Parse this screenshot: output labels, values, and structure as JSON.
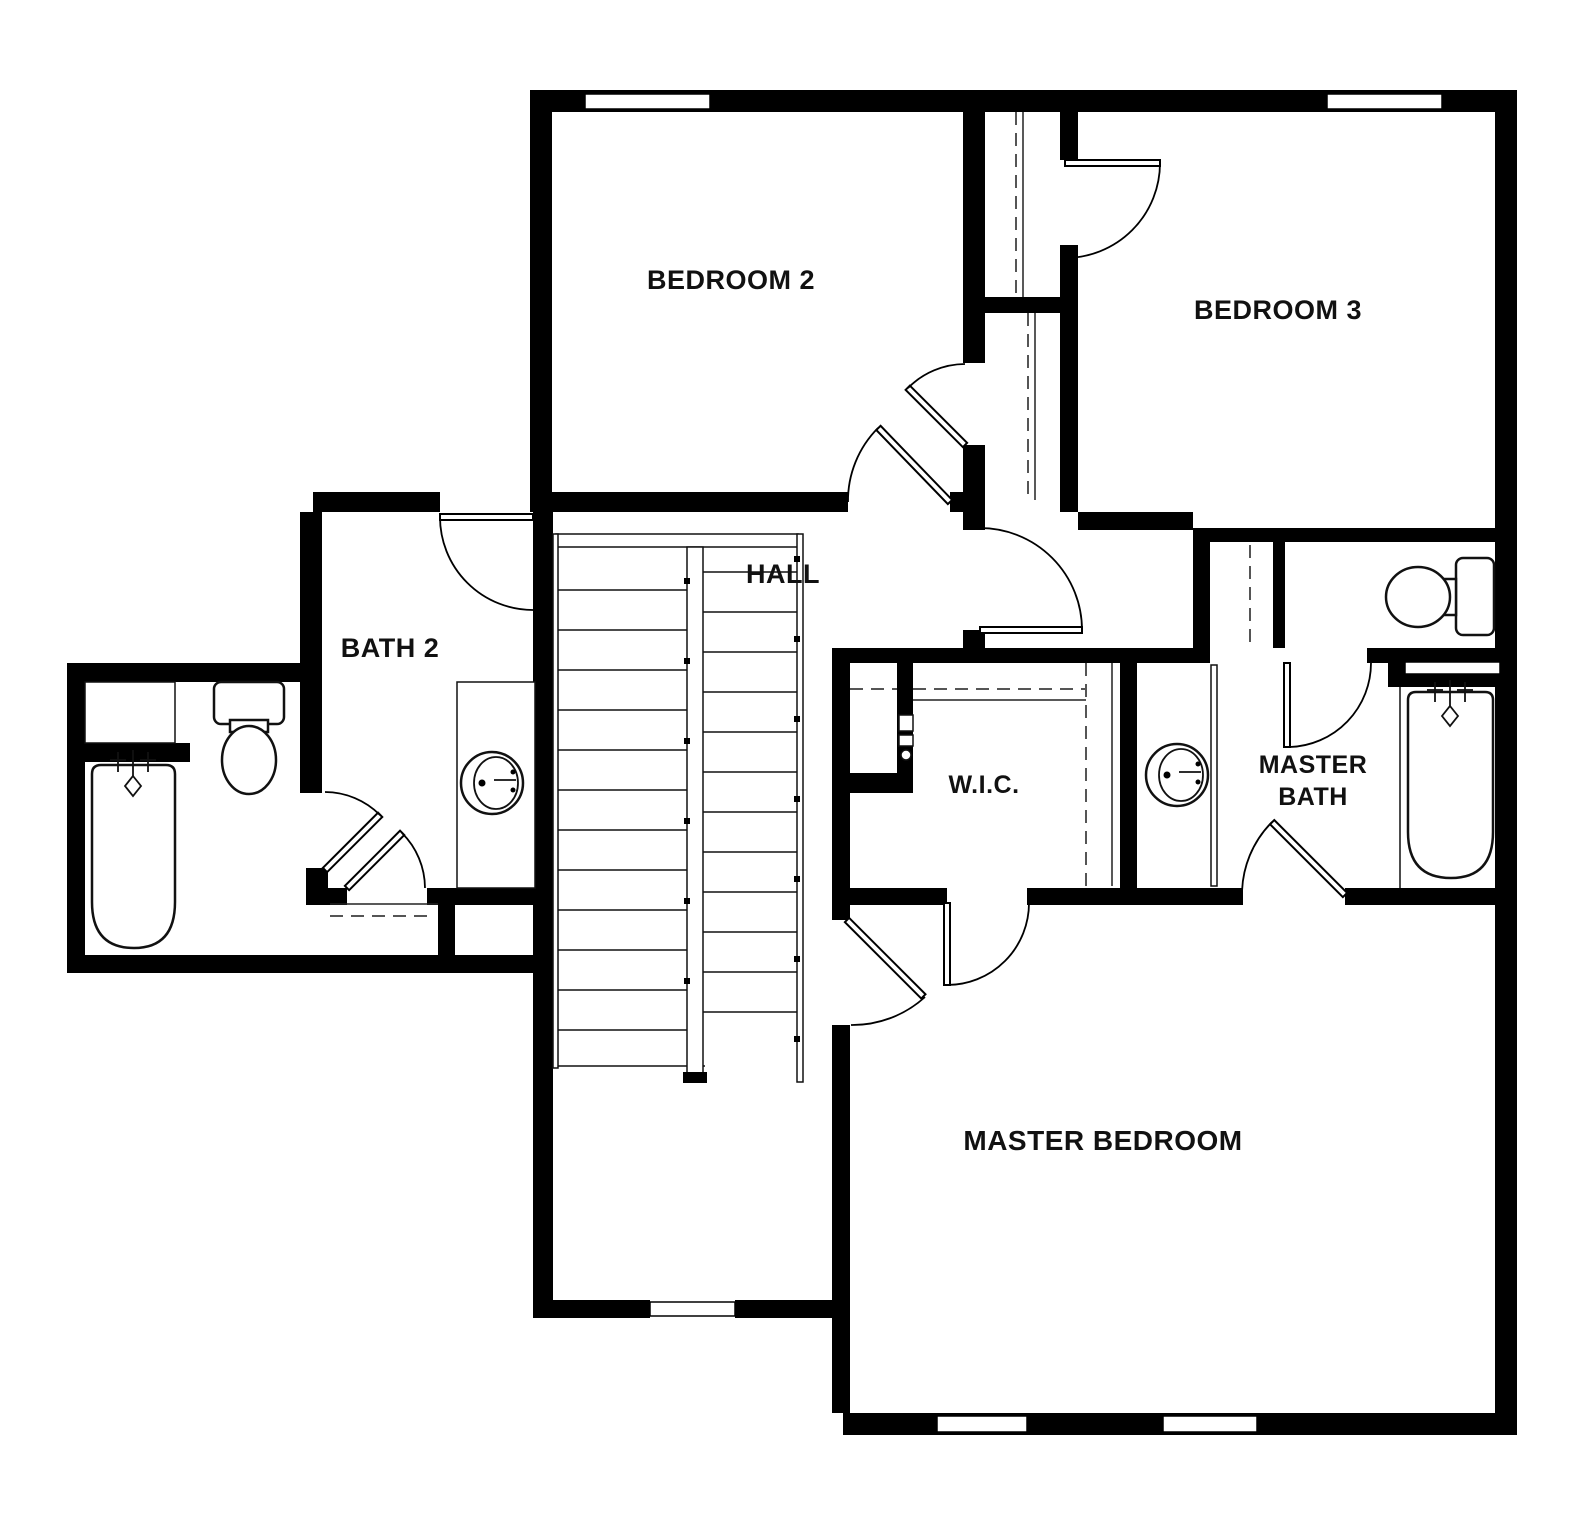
{
  "plan": {
    "type": "residential-floor-plan",
    "floor": "upper",
    "colors": {
      "wall": "#000000",
      "background": "#ffffff",
      "text": "#111111",
      "closet_rod_dash": "#555555"
    }
  },
  "rooms": {
    "bedroom2": {
      "label": "BEDROOM 2"
    },
    "bedroom3": {
      "label": "BEDROOM 3"
    },
    "hall": {
      "label": "HALL"
    },
    "bath2": {
      "label": "BATH 2"
    },
    "wic": {
      "label": "W.I.C."
    },
    "master_bath": {
      "line1": "MASTER",
      "line2": "BATH"
    },
    "master_bedroom": {
      "label": "MASTER BEDROOM"
    }
  },
  "fixtures": [
    "bathtub-bath2",
    "toilet-bath2",
    "sink-vanity-bath2",
    "bathtub-master",
    "toilet-master",
    "sink-vanity-master",
    "staircase",
    "utility-panel"
  ],
  "counts": {
    "doors": 11,
    "windows": 5,
    "closets": 6
  }
}
